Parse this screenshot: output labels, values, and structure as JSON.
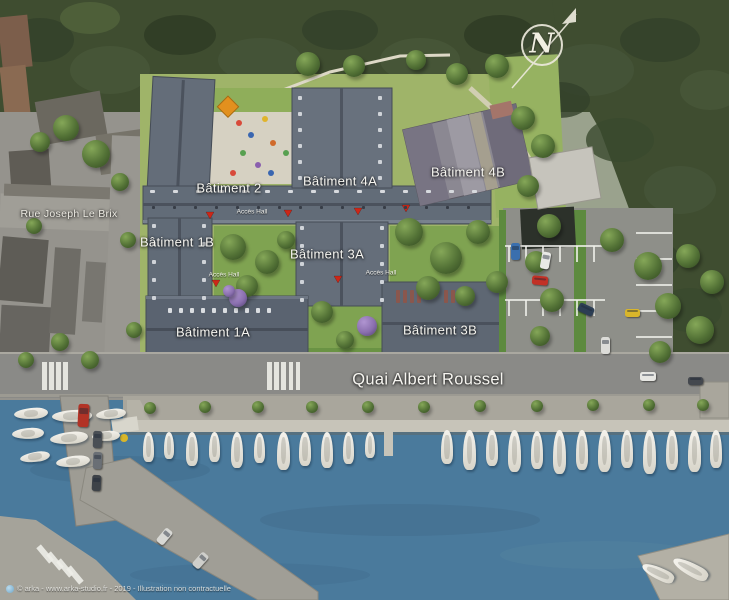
{
  "map": {
    "streets": {
      "rue_joseph_le_brix": "Rue Joseph Le Brix",
      "quai_albert_roussel": "Quai Albert Roussel"
    },
    "buildings": [
      {
        "id": "batiment-2",
        "label": "Bâtiment 2"
      },
      {
        "id": "batiment-4a",
        "label": "Bâtiment 4A"
      },
      {
        "id": "batiment-4b",
        "label": "Bâtiment 4B"
      },
      {
        "id": "batiment-1b",
        "label": "Bâtiment 1B"
      },
      {
        "id": "batiment-3a",
        "label": "Bâtiment 3A"
      },
      {
        "id": "batiment-1a",
        "label": "Bâtiment 1A"
      },
      {
        "id": "batiment-3b",
        "label": "Bâtiment 3B"
      }
    ],
    "access_hall_label": "Accès Hall",
    "compass": {
      "north_label": "N"
    },
    "credit": "© arka - www.arka-studio.fr - 2019 - Illustration non contractuelle",
    "colors": {
      "water": "#4a7a9c",
      "woodland": "#3f4d30",
      "lawn": "#9fb469",
      "new_roof": "#626c78",
      "existing_roof": "#8b8892",
      "road": "#8a8a87",
      "pontoon": "#c7c4b9",
      "access_marker": "#cc2718",
      "parasol": "#e2901e",
      "flowering_tree": "#8a6fae"
    }
  }
}
